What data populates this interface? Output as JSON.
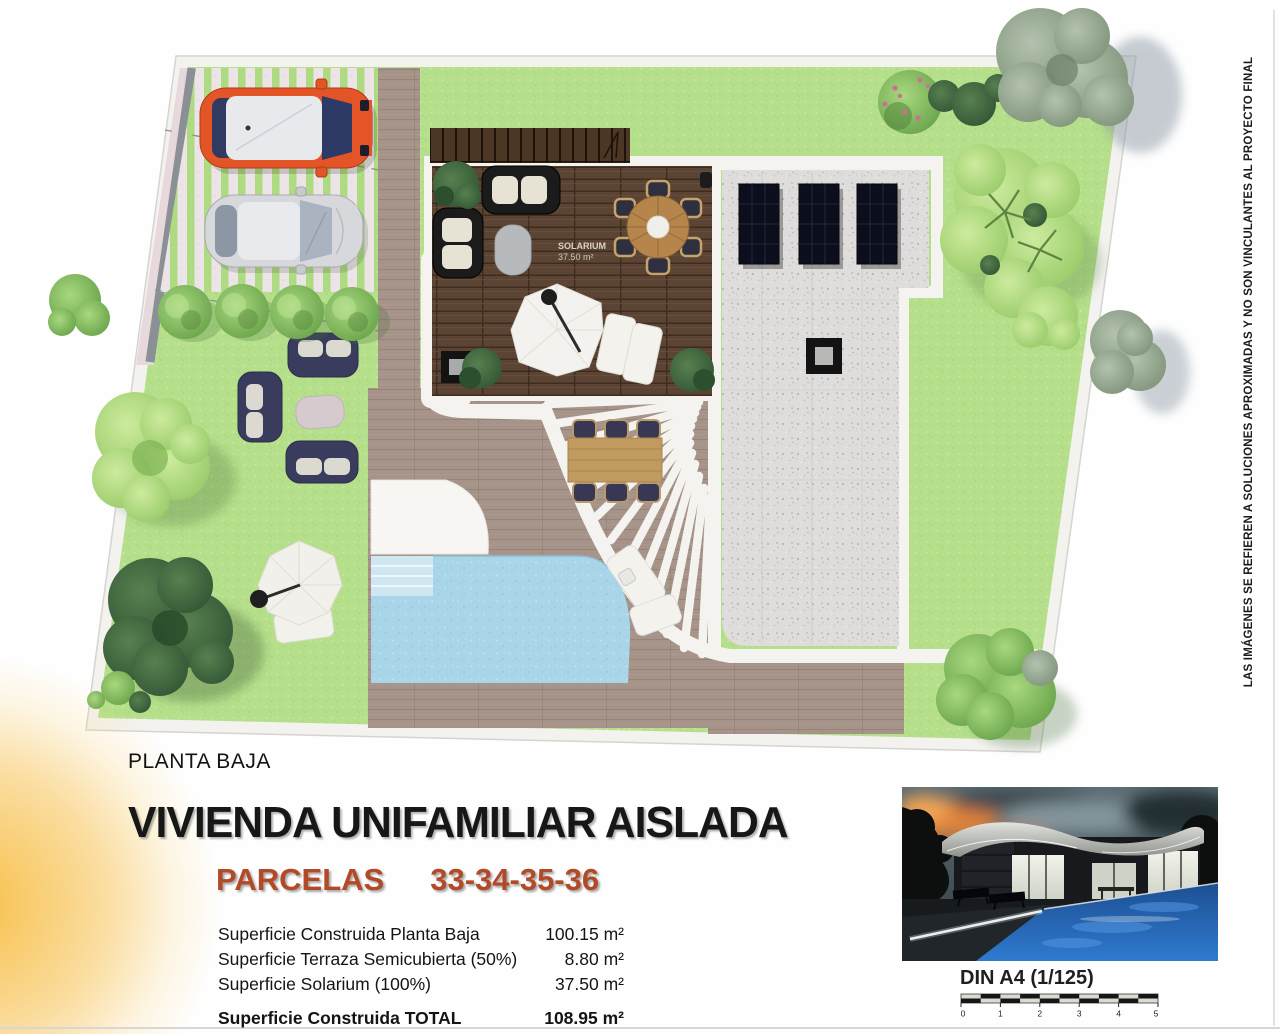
{
  "page": {
    "background": "#ffffff"
  },
  "colors": {
    "accent_red": "#b24a28",
    "lawn_green": "#b5df8a",
    "pool_blue": "#a9d5e8",
    "deck_brown": "#5b4433",
    "terrace_taupe": "#a6938a",
    "gravel_gray": "#dedddb",
    "car_orange": "#e35427",
    "car_silver": "#d7d8db",
    "sofa_navy": "#3a3c5e",
    "solar_panel": "#0c0e1c",
    "sun_glow": "#f6ba42"
  },
  "plan": {
    "solarium_label_line1": "SOLARIUM",
    "solarium_label_line2": "37.50 m²"
  },
  "disclaimer": "LAS IMÁGENES SE REFIEREN A SOLUCIONES APROXIMADAS Y NO SON VINCULANTES AL PROYECTO FINAL",
  "info": {
    "floor_label": "PLANTA BAJA",
    "title": "VIVIENDA UNIFAMILIAR AISLADA",
    "parcels_label": "PARCELAS",
    "parcels_numbers": "33-34-35-36",
    "areas": [
      {
        "label": "Superficie Construida Planta Baja",
        "value": "100.15 m²"
      },
      {
        "label": "Superficie Terraza Semicubierta (50%)",
        "value": "8.80 m²"
      },
      {
        "label": "Superficie Solarium (100%)",
        "value": "37.50 m²"
      }
    ],
    "total": {
      "label": "Superficie Construida TOTAL",
      "value": "108.95 m²"
    }
  },
  "photo": {
    "caption": "DIN A4 (1/125)",
    "scale_ticks": [
      "0",
      "1",
      "2",
      "3",
      "4",
      "5"
    ]
  }
}
